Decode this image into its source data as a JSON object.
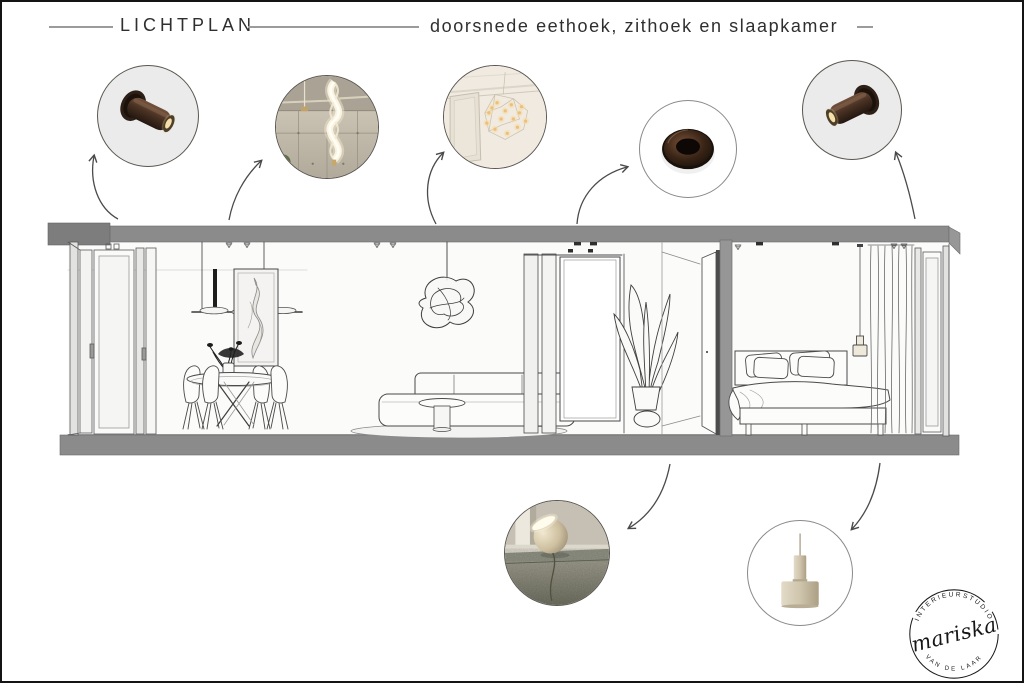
{
  "header": {
    "title_left": "LICHTPLAN",
    "title_right": "doorsnede eethoek, zithoek en slaapkamer"
  },
  "logo": {
    "name": "mariska",
    "arc_top": "INTERIEURSTUDIO",
    "arc_bottom": "VAN DE LAAR"
  },
  "colors": {
    "header_line": "#9b9b9b",
    "ink": "#2f2f2f",
    "circle_bg": "#ebebeb",
    "slab_gray": "#8b8b8b",
    "line_dark": "#4a4a4a",
    "bronze": "#4a3223",
    "warm_glow": "#f7dfa8",
    "lamp_beige": "#d3c9b4",
    "stone_green": "#8f9283"
  }
}
